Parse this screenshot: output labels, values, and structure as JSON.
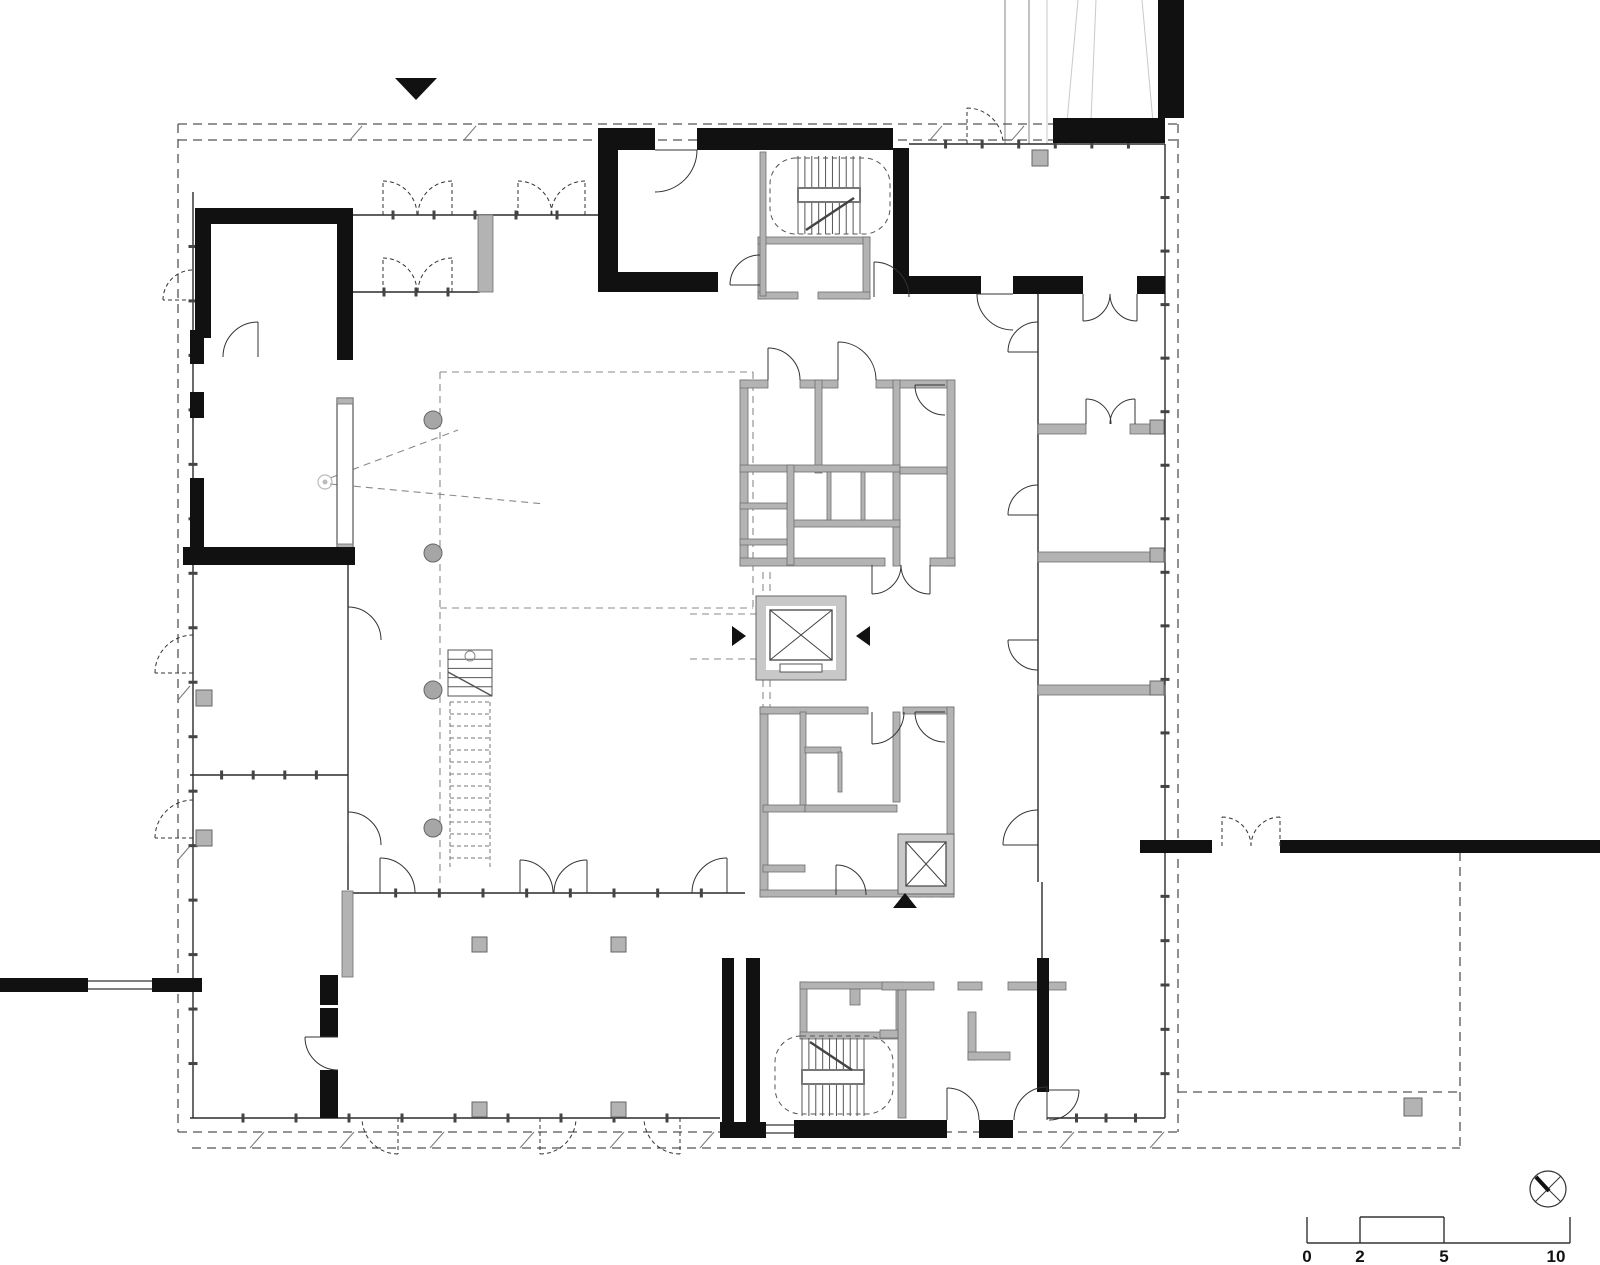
{
  "meta": {
    "drawing_type": "architectural-floor-plan",
    "bg": "#ffffff",
    "ink": "#111111",
    "gray_wall": "#b3b3b3",
    "gray_stroke": "#6e6e6e",
    "thin": "#2b2b2b",
    "dash": "#555555",
    "light_dash": "#8a8a8a",
    "light_line": "#c9c9c9",
    "tick": "#444444"
  },
  "scale_bar": {
    "labels": [
      "0",
      "2",
      "5",
      "10"
    ],
    "label_xs": [
      1307,
      1360,
      1444,
      1556
    ],
    "label_y": 1247,
    "x0": 1307,
    "x1": 1570,
    "baseline_y": 1243,
    "top_y": 1217,
    "verticals": [
      1307,
      1360,
      1444,
      1570
    ],
    "raised": [
      1360,
      1444
    ]
  },
  "north_symbol": {
    "cx": 1548,
    "cy": 1189,
    "r": 18,
    "thin": [
      [
        1535,
        1176,
        1561,
        1202
      ],
      [
        1535,
        1202,
        1561,
        1176
      ]
    ],
    "needle": [
      1536,
      1177,
      1549,
      1191
    ]
  },
  "markers": {
    "entrance_triangle_top": [
      [
        395,
        78
      ],
      [
        437,
        78
      ],
      [
        416,
        100
      ]
    ],
    "entrance_triangle_south": [
      [
        893,
        908
      ],
      [
        917,
        908
      ],
      [
        905,
        893
      ]
    ],
    "section_arrow_left": [
      [
        732,
        626
      ],
      [
        732,
        646
      ],
      [
        746,
        636
      ]
    ],
    "section_arrow_right": [
      [
        870,
        626
      ],
      [
        870,
        646
      ],
      [
        856,
        636
      ]
    ]
  },
  "black_walls": [
    [
      598,
      128,
      20,
      164
    ],
    [
      598,
      128,
      57,
      22
    ],
    [
      697,
      128,
      196,
      22
    ],
    [
      598,
      272,
      120,
      20
    ],
    [
      893,
      148,
      16,
      146
    ],
    [
      893,
      276,
      88,
      18
    ],
    [
      1013,
      276,
      70,
      18
    ],
    [
      1137,
      276,
      28,
      18
    ],
    [
      1053,
      118,
      112,
      25
    ],
    [
      1158,
      0,
      26,
      118
    ],
    [
      195,
      208,
      158,
      16
    ],
    [
      195,
      208,
      16,
      130
    ],
    [
      337,
      208,
      16,
      152
    ],
    [
      190,
      330,
      14,
      34
    ],
    [
      190,
      392,
      14,
      26
    ],
    [
      190,
      478,
      14,
      70
    ],
    [
      183,
      547,
      172,
      18
    ],
    [
      320,
      975,
      18,
      30
    ],
    [
      320,
      1008,
      18,
      29
    ],
    [
      320,
      1070,
      18,
      48
    ],
    [
      720,
      1122,
      46,
      16
    ],
    [
      794,
      1120,
      153,
      18
    ],
    [
      979,
      1120,
      34,
      18
    ],
    [
      722,
      958,
      12,
      164
    ],
    [
      746,
      958,
      14,
      164
    ],
    [
      1037,
      958,
      12,
      134
    ],
    [
      0,
      978,
      88,
      14
    ],
    [
      152,
      978,
      50,
      14
    ],
    [
      1140,
      840,
      72,
      13
    ],
    [
      1280,
      840,
      320,
      13
    ]
  ],
  "gray_walls": [
    [
      740,
      380,
      8,
      186
    ],
    [
      740,
      380,
      28,
      8
    ],
    [
      800,
      380,
      38,
      8
    ],
    [
      876,
      380,
      78,
      8
    ],
    [
      947,
      380,
      8,
      186
    ],
    [
      740,
      558,
      145,
      8
    ],
    [
      930,
      558,
      25,
      8
    ],
    [
      815,
      380,
      7,
      93
    ],
    [
      893,
      380,
      7,
      186
    ],
    [
      740,
      465,
      160,
      7
    ],
    [
      787,
      520,
      113,
      7
    ],
    [
      787,
      465,
      7,
      100
    ],
    [
      740,
      503,
      47,
      6
    ],
    [
      740,
      539,
      47,
      6
    ],
    [
      827,
      472,
      4,
      48
    ],
    [
      861,
      472,
      4,
      48
    ],
    [
      900,
      467,
      47,
      7
    ],
    [
      760,
      707,
      8,
      190
    ],
    [
      760,
      707,
      108,
      7
    ],
    [
      903,
      707,
      51,
      7
    ],
    [
      947,
      707,
      7,
      190
    ],
    [
      760,
      890,
      194,
      7
    ],
    [
      800,
      712,
      6,
      95
    ],
    [
      763,
      805,
      42,
      7
    ],
    [
      763,
      865,
      42,
      7
    ],
    [
      805,
      805,
      92,
      7
    ],
    [
      893,
      712,
      7,
      90
    ],
    [
      805,
      747,
      36,
      6
    ],
    [
      838,
      752,
      4,
      40
    ],
    [
      758,
      237,
      7,
      62
    ],
    [
      758,
      237,
      112,
      7
    ],
    [
      863,
      237,
      7,
      62
    ],
    [
      758,
      292,
      40,
      7
    ],
    [
      818,
      292,
      52,
      7
    ],
    [
      800,
      982,
      7,
      55
    ],
    [
      800,
      982,
      103,
      7
    ],
    [
      896,
      982,
      7,
      55
    ],
    [
      800,
      1032,
      103,
      7
    ],
    [
      850,
      989,
      10,
      16
    ],
    [
      478,
      215,
      15,
      77
    ],
    [
      760,
      152,
      6,
      144
    ],
    [
      1038,
      424,
      48,
      10
    ],
    [
      1130,
      424,
      27,
      10
    ],
    [
      1038,
      552,
      127,
      10
    ],
    [
      1038,
      685,
      127,
      10
    ],
    [
      882,
      982,
      52,
      8
    ],
    [
      958,
      982,
      24,
      8
    ],
    [
      1008,
      982,
      58,
      8
    ],
    [
      898,
      990,
      8,
      128
    ],
    [
      880,
      1030,
      18,
      8
    ],
    [
      968,
      1012,
      8,
      48
    ],
    [
      968,
      1052,
      42,
      8
    ],
    [
      342,
      891,
      11,
      86
    ],
    [
      337,
      398,
      16,
      6
    ],
    [
      337,
      544,
      16,
      6
    ]
  ],
  "white_piers": [
    [
      337,
      398,
      16,
      152
    ]
  ],
  "columns_round": {
    "r": 9,
    "pts": [
      [
        433,
        420
      ],
      [
        433,
        553
      ],
      [
        433,
        690
      ],
      [
        433,
        828
      ]
    ]
  },
  "columns_square": [
    [
      472,
      937,
      15
    ],
    [
      611,
      937,
      15
    ],
    [
      472,
      1102,
      15
    ],
    [
      611,
      1102,
      15
    ],
    [
      196,
      690,
      16
    ],
    [
      196,
      830,
      16
    ],
    [
      1032,
      150,
      16
    ],
    [
      1150,
      420,
      14
    ],
    [
      1150,
      548,
      14
    ],
    [
      1150,
      681,
      14
    ],
    [
      1404,
      1098,
      18
    ]
  ],
  "thin_lines": [
    [
      1038,
      294,
      1038,
      882
    ],
    [
      348,
      565,
      348,
      890
    ],
    [
      1042,
      882,
      1042,
      958
    ]
  ],
  "ticked_walls": [
    [
      909,
      144,
      1165,
      144,
      6
    ],
    [
      193,
      192,
      193,
      1118,
      16
    ],
    [
      190,
      1118,
      720,
      1118,
      9
    ],
    [
      1047,
      1118,
      1165,
      1118,
      3
    ],
    [
      1165,
      144,
      1165,
      840,
      12
    ],
    [
      1165,
      852,
      1165,
      1118,
      5
    ],
    [
      352,
      893,
      745,
      893,
      8
    ],
    [
      190,
      775,
      348,
      775,
      4
    ],
    [
      352,
      215,
      598,
      215,
      5
    ],
    [
      352,
      292,
      480,
      292,
      3
    ]
  ],
  "dash_lines": [
    [
      178,
      124,
      1178,
      124
    ],
    [
      178,
      140,
      1178,
      140
    ],
    [
      178,
      124,
      178,
      1132
    ],
    [
      1178,
      124,
      1178,
      1132
    ],
    [
      178,
      1132,
      1178,
      1132
    ],
    [
      192,
      1148,
      1460,
      1148
    ],
    [
      1460,
      852,
      1460,
      1148
    ],
    [
      1178,
      1092,
      1460,
      1092
    ]
  ],
  "light_dash_lines": [
    [
      440,
      372,
      753,
      372
    ],
    [
      753,
      372,
      753,
      608
    ],
    [
      440,
      608,
      753,
      608
    ],
    [
      440,
      372,
      440,
      885
    ],
    [
      690,
      614,
      756,
      614
    ],
    [
      690,
      659,
      756,
      659
    ],
    [
      763,
      572,
      763,
      707
    ],
    [
      770,
      572,
      770,
      707
    ],
    [
      330,
      478,
      458,
      430
    ],
    [
      330,
      484,
      545,
      504
    ],
    [
      903,
      897,
      947,
      897
    ]
  ],
  "hatches": [
    [
      350,
      140,
      362,
      126
    ],
    [
      464,
      140,
      476,
      126
    ],
    [
      930,
      140,
      942,
      126
    ],
    [
      1012,
      140,
      1024,
      126
    ],
    [
      250,
      1148,
      264,
      1132
    ],
    [
      340,
      1148,
      354,
      1132
    ],
    [
      430,
      1148,
      444,
      1132
    ],
    [
      520,
      1148,
      534,
      1132
    ],
    [
      610,
      1148,
      624,
      1132
    ],
    [
      700,
      1148,
      714,
      1132
    ],
    [
      1060,
      1148,
      1074,
      1132
    ],
    [
      1150,
      1148,
      1164,
      1132
    ],
    [
      178,
      700,
      190,
      686
    ],
    [
      178,
      860,
      190,
      846
    ]
  ],
  "windows": [
    {
      "bg": [
        88,
        977,
        64,
        16
      ],
      "lines": [
        [
          88,
          981,
          152,
          981
        ],
        [
          88,
          989,
          152,
          989
        ]
      ]
    },
    {
      "bg": [
        766,
        1119,
        28,
        20
      ],
      "lines": [
        [
          766,
          1125,
          794,
          1125
        ],
        [
          766,
          1133,
          794,
          1133
        ]
      ]
    }
  ],
  "doors": [
    [
      655,
      150,
      42,
      0,
      90,
      0
    ],
    [
      258,
      357,
      35,
      270,
      180,
      0
    ],
    [
      383,
      215,
      34,
      270,
      0,
      1
    ],
    [
      452,
      215,
      34,
      270,
      180,
      1
    ],
    [
      518,
      215,
      34,
      270,
      0,
      1
    ],
    [
      585,
      215,
      34,
      270,
      180,
      1
    ],
    [
      383,
      292,
      34,
      270,
      0,
      1
    ],
    [
      452,
      292,
      34,
      270,
      180,
      1
    ],
    [
      1013,
      294,
      36,
      180,
      90,
      0
    ],
    [
      1083,
      294,
      27,
      90,
      0,
      0
    ],
    [
      1137,
      294,
      27,
      90,
      180,
      0
    ],
    [
      874,
      297,
      35,
      270,
      0,
      0
    ],
    [
      760,
      285,
      30,
      180,
      270,
      0
    ],
    [
      1038,
      352,
      30,
      180,
      270,
      0
    ],
    [
      1038,
      515,
      30,
      180,
      270,
      0
    ],
    [
      1038,
      640,
      30,
      180,
      90,
      0
    ],
    [
      1038,
      845,
      35,
      180,
      270,
      0
    ],
    [
      1086,
      424,
      25,
      270,
      0,
      0
    ],
    [
      1135,
      424,
      25,
      270,
      180,
      0
    ],
    [
      768,
      380,
      32,
      270,
      0,
      0
    ],
    [
      838,
      380,
      38,
      270,
      0,
      0
    ],
    [
      945,
      385,
      30,
      180,
      90,
      0
    ],
    [
      872,
      565,
      29,
      90,
      0,
      0
    ],
    [
      930,
      565,
      29,
      90,
      180,
      0
    ],
    [
      872,
      712,
      32,
      90,
      0,
      0
    ],
    [
      945,
      712,
      30,
      180,
      90,
      0
    ],
    [
      836,
      895,
      30,
      270,
      0,
      0
    ],
    [
      380,
      893,
      35,
      270,
      0,
      0
    ],
    [
      520,
      893,
      33,
      270,
      0,
      0
    ],
    [
      587,
      893,
      33,
      270,
      180,
      0
    ],
    [
      727,
      893,
      35,
      270,
      180,
      0
    ],
    [
      338,
      1037,
      33,
      180,
      90,
      0
    ],
    [
      947,
      1120,
      32,
      270,
      0,
      0
    ],
    [
      1047,
      1120,
      33,
      270,
      180,
      0
    ],
    [
      1049,
      1090,
      30,
      0,
      90,
      0
    ],
    [
      1222,
      846,
      29,
      270,
      0,
      1
    ],
    [
      1280,
      846,
      29,
      270,
      180,
      1
    ],
    [
      348,
      640,
      33,
      270,
      0,
      0
    ],
    [
      348,
      845,
      33,
      270,
      0,
      0
    ],
    [
      193,
      673,
      38,
      180,
      270,
      1
    ],
    [
      193,
      838,
      38,
      180,
      270,
      1
    ],
    [
      193,
      300,
      30,
      180,
      270,
      1
    ],
    [
      398,
      1118,
      36,
      90,
      180,
      1
    ],
    [
      540,
      1118,
      36,
      90,
      0,
      1
    ],
    [
      680,
      1118,
      36,
      90,
      180,
      1
    ],
    [
      967,
      144,
      36,
      270,
      0,
      1
    ]
  ],
  "stair_cores": [
    {
      "x": 798,
      "y": 156,
      "w": 62,
      "h": 78,
      "n": 9,
      "landing": [
        798,
        188,
        62,
        14
      ],
      "diag": [
        806,
        230,
        854,
        198
      ],
      "outline": [
        770,
        158,
        120,
        76
      ]
    },
    {
      "x": 802,
      "y": 1038,
      "w": 62,
      "h": 78,
      "n": 9,
      "landing": [
        802,
        1070,
        62,
        14
      ],
      "diag": [
        810,
        1042,
        852,
        1070
      ],
      "outline": [
        775,
        1036,
        118,
        78
      ]
    }
  ],
  "open_stair": {
    "x": 448,
    "y": 650,
    "w": 44,
    "solid_h": 46,
    "solid_treads": 5,
    "diag": [
      448,
      672,
      492,
      696
    ],
    "post": [
      470,
      656,
      5
    ],
    "dash_from": 702,
    "dash_to": 868,
    "dash_step": 12
  },
  "elevators": {
    "main": {
      "x": 756,
      "y": 596,
      "w": 90,
      "h": 84,
      "inner": [
        766,
        606,
        70,
        64
      ],
      "car": [
        770,
        610,
        62,
        50
      ],
      "sill": [
        780,
        664,
        42,
        8
      ]
    },
    "small": {
      "x": 898,
      "y": 834,
      "w": 56,
      "h": 60,
      "car": [
        906,
        842,
        40,
        44
      ]
    }
  },
  "ramp_lines": {
    "solid": [
      [
        1005,
        0,
        1005,
        144
      ],
      [
        1029,
        0,
        1029,
        144
      ]
    ],
    "light": [
      [
        1047,
        0,
        1047,
        144
      ],
      [
        1078,
        0,
        1065,
        144
      ],
      [
        1142,
        0,
        1155,
        144
      ],
      [
        1096,
        0,
        1090,
        144
      ]
    ]
  },
  "eye_symbol": {
    "cx": 325,
    "cy": 482,
    "r": 7
  }
}
